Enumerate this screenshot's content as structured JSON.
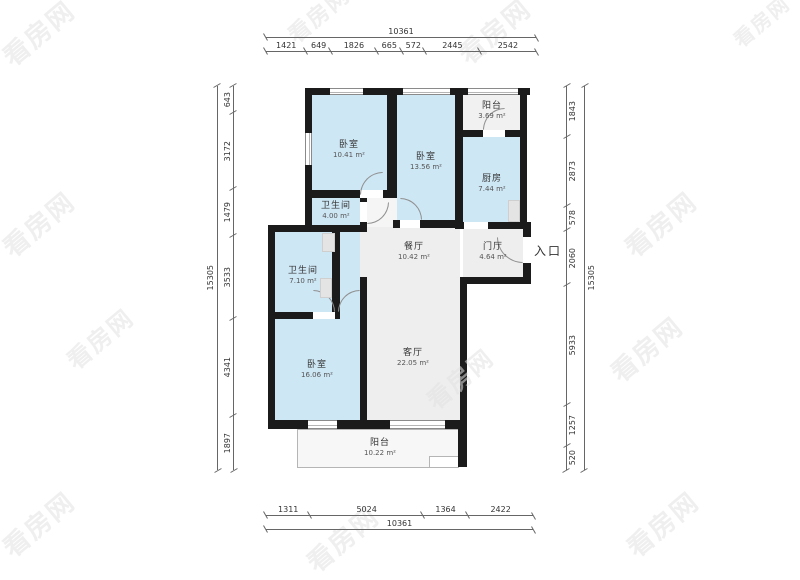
{
  "watermark": {
    "text": "看房网"
  },
  "colors": {
    "wall": "#1b1b1b",
    "room_blue": "#cee7f5",
    "room_gray": "#eeeeee"
  },
  "entrance": {
    "label": "入口"
  },
  "rooms": [
    {
      "id": "bedroom-1",
      "name": "卧室",
      "area": "10.41 m²"
    },
    {
      "id": "bedroom-2",
      "name": "卧室",
      "area": "13.56 m²"
    },
    {
      "id": "balcony-top",
      "name": "阳台",
      "area": "3.69 m²"
    },
    {
      "id": "kitchen",
      "name": "厨房",
      "area": "7.44 m²"
    },
    {
      "id": "bathroom-small",
      "name": "卫生间",
      "area": "4.00 m²"
    },
    {
      "id": "dining-room",
      "name": "餐厅",
      "area": "10.42 m²"
    },
    {
      "id": "foyer",
      "name": "门厅",
      "area": "4.64 m²"
    },
    {
      "id": "bathroom-left",
      "name": "卫生间",
      "area": "7.10 m²"
    },
    {
      "id": "bedroom-3",
      "name": "卧室",
      "area": "16.06 m²"
    },
    {
      "id": "living-room",
      "name": "客厅",
      "area": "22.05 m²"
    },
    {
      "id": "balcony-bottom",
      "name": "阳台",
      "area": "10.22 m²"
    }
  ],
  "dimensions": {
    "top": {
      "overall": "10361",
      "segments": [
        1421,
        649,
        1826,
        665,
        572,
        2445,
        2542
      ]
    },
    "bottom": {
      "overall": "10361",
      "segments": [
        1311,
        5024,
        1364,
        2422
      ]
    },
    "left": {
      "overall": "15305",
      "segments": [
        643,
        3172,
        1479,
        3533,
        4341,
        1897
      ]
    },
    "right": {
      "overall": "15305",
      "segments": [
        1843,
        2873,
        578,
        2060,
        5933,
        1257,
        520
      ]
    }
  }
}
